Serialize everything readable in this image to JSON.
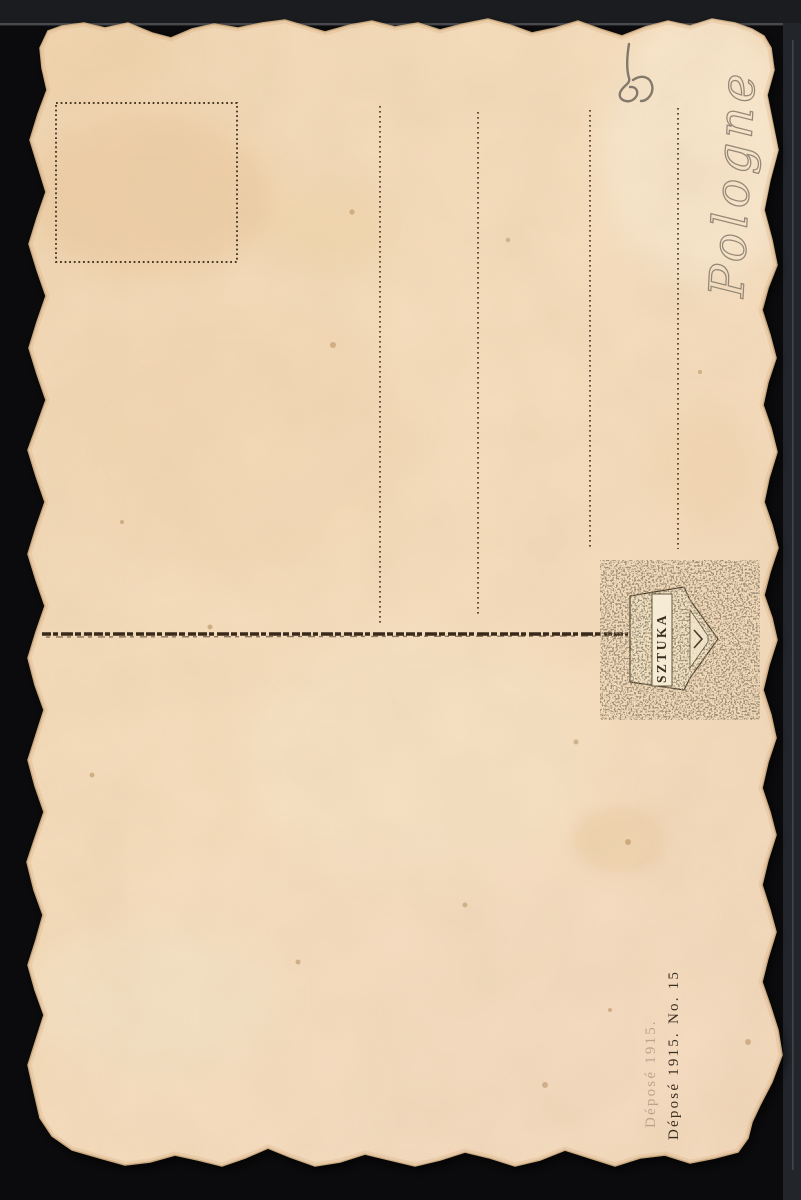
{
  "postcard": {
    "kind_label": "postcard back (blank, rotated scan)",
    "printed": {
      "deposit_line": "Déposé 1915.",
      "number_line": "No. 15",
      "publisher_mark_text": "SZTUKA"
    },
    "handwritten": {
      "place_text": "Pologne",
      "corner_mark_text": "5"
    },
    "colors": {
      "scanner_background": "#0b0b0d",
      "scanner_strip": "#23272c",
      "paper_base": "#f3dab9",
      "paper_light": "#f9ead3",
      "paper_stain": "#e7c296",
      "print_ink": "#3a2e1f",
      "dotted_rule": "#4a3a25",
      "pencil": "#8a7e6e"
    }
  }
}
